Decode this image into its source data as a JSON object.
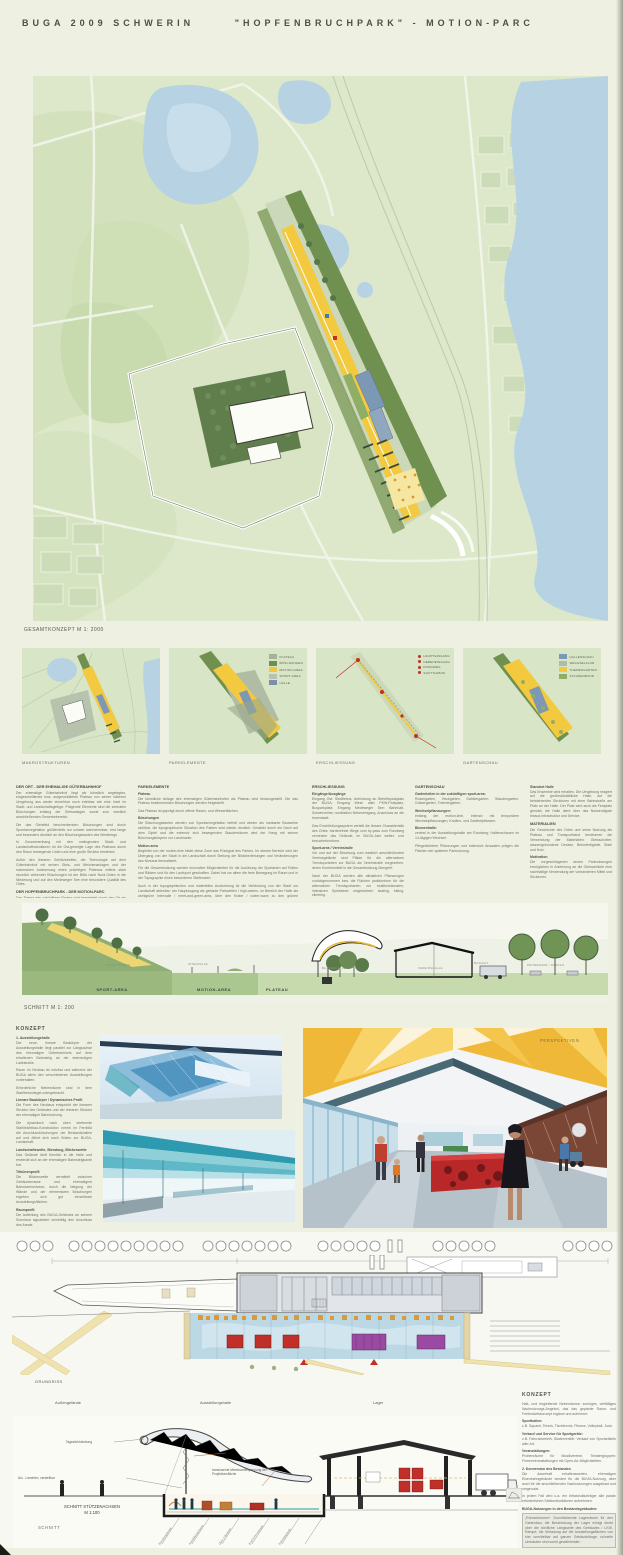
{
  "page": {
    "title_left": "BUGA 2009 SCHWERIN",
    "title_right": "\"HOPFENBRUCHPARK\" - MOTION-PARC"
  },
  "colors": {
    "map_green": "#dce8c9",
    "water": "#b7d3e3",
    "boeschung_olive": "#70904f",
    "motion_yellow": "#f2c93f",
    "plateau": "#cbd8ba",
    "halle_blue": "#7d98b5",
    "canopy_orange": "#f0b838",
    "exhibit_red": "#c03028",
    "exhibit_purple": "#9a4aa0"
  },
  "masterplan": {
    "caption": "GESAMTKONZEPT  M 1: 2000"
  },
  "panels": {
    "p1": {
      "caption": "MAKROSTRUKTUREN"
    },
    "p2": {
      "caption": "PARKELEMENTE",
      "legend": [
        {
          "label": "PLATEAU",
          "color": "#a4b296"
        },
        {
          "label": "BÖSCHUNGEN",
          "color": "#6e8f4f"
        },
        {
          "label": "MOTION-AREA",
          "color": "#f0c840"
        },
        {
          "label": "SPORT-AREA",
          "color": "#b9c2b2"
        },
        {
          "label": "HALLE",
          "color": "#7b8fa6"
        }
      ]
    },
    "p3": {
      "caption": "ERSCHLIESSUNG",
      "legend": [
        {
          "label": "HAUPTEINGANG"
        },
        {
          "label": "NEBENEINGANG"
        },
        {
          "label": "RUNDWEG"
        },
        {
          "label": "SHUTTLEBUS"
        }
      ]
    },
    "p4": {
      "caption": "GARTENSCHAU",
      "legend": [
        {
          "label": "HALLENSCHAU"
        },
        {
          "label": "WECHSELFLOR"
        },
        {
          "label": "THEMENGÄRTEN"
        },
        {
          "label": "STAUDENBAND"
        }
      ]
    }
  },
  "columns": [
    {
      "blocks": [
        {
          "type": "h",
          "text": "DER ORT - DER EHEMALIGE GÜTERBAHNHOF"
        },
        {
          "type": "p",
          "text": "Der ehemalige Güterbahnhof liegt als künstlich angelegtes, eingeschnittenes bzw. aufgeschüttetes Plateau von seiner näheren Umgebung aus weder einsehbar noch erlebbar wie eine Insel im Stadt- und Landschaftsgefüge. Prägende Elemente sind die zentralen Böschungen entlang der Gleisanlagen sowie zum westlich anschließenden Gewerbebereich."
        },
        {
          "type": "p",
          "text": "Die das Gleisfeld beschreibenden Böschungen sind durch Spontanvegetation größtenteils nur schwer wahrnehmbar, erst lange und besonders deutlich an den Böschungskanten des Westbergs."
        },
        {
          "type": "p",
          "text": "In Zusammenhang mit den umliegenden Stadt- und Landschaftsstrukturen ist die Ost-geneigte Lage des Plateaus durch den Raum bewegende Linien und eine große Struktur bestimmt."
        },
        {
          "type": "p",
          "text": "Außer den linearen Gehölzstreifen, der Technologie auf dem Güterbahnhof mit seinen Gleis- und Weichenanlagen und der naturnahen Ausformung eines prächtigen Plateaus mittels stark räumlich wirkender Böschungen ist der Blick nach Nord-Osten in die Niederung und auf den Medeweger See eine besondere Qualität des Ortes."
        },
        {
          "type": "h",
          "text": "DER HOPFENBRUCHPARK - DER MOTION-PARC"
        },
        {
          "type": "p",
          "text": "Das Thema des zukünftigen Parkes wird hergeleitet durch den Ort als ehemaliger Güterbahnhof und seine vorhandenen Strukturen: Lineare Elemente, Bewegung, ständige Veränderung, Motion."
        },
        {
          "type": "p",
          "text": "Der Park hat einen offenen großzügigen Charakter und stellt die Verbindung zwischen der Stadt und der Landschaft mit dem Medeweger See im Norden her."
        },
        {
          "type": "p",
          "text": "Er wird deutlich in die Zonen gegliedert: Plateau, Böschungen, motion-area und sport-area."
        }
      ]
    },
    {
      "blocks": [
        {
          "type": "h",
          "text": "PARKELEMENTE"
        },
        {
          "type": "h2",
          "text": "Plateau"
        },
        {
          "type": "p",
          "text": "Die künstliche Anlage des ehemaligen Güterbahnhofes als Plateau wird herausgestellt. Die das Plateau bestimmenden Böschungen werden freigestellt."
        },
        {
          "type": "p",
          "text": "Das Plateau ist geprägt durch offene Rasen- und Wiesenflächen."
        },
        {
          "type": "h2",
          "text": "Böschungen"
        },
        {
          "type": "p",
          "text": "Die Böschungskanten werden von Spontanvegetation befreit und wieder als markante Bauwerke sichtbar, die topographische Situation des Parkes wird wieder deutlich. Gestärkt durch ein Dach auf dem Gipfel und die extensiv sich bewegenden Staudenräume wird der Hang mit seinen Böschungskörpern zur Landmarke."
        },
        {
          "type": "h2",
          "text": "Motion-area"
        },
        {
          "type": "p",
          "text": "Begleitet von der motion-linie bildet diese Zone das Rückgrat des Parkes. Im oberen Bereich wird der Übergang von der Stadt in die Landschaft durch Stellung der Blickbeziehungen und Veränderungen des Niveaus thematisiert."
        },
        {
          "type": "p",
          "text": "Für die Gesamtnutzung werden innovative Möglichkeiten für die Ausübung der Sportarten auf Rollen und Rädern und für den Laufsport geschaffen. Dabei hat vor allem die freie Bewegung im Raum und in der Topographie einen besonderen Stellenwert."
        },
        {
          "type": "p",
          "text": "Auch in der topographischen und materiellen Ausformung ist die Verbindung von der Stadt zur Landschaft ablesbar: am Hauptzugang als gebaute Parkwellen / high-waves, im Bereich der Halle als wohlgrüne Intervalle / meet-and-green-area, über den Krater / crater-wave zu den grünen Landschaftswellen / green-range oberhalb des Medeweger Sees."
        }
      ]
    },
    {
      "blocks": [
        {
          "type": "h",
          "text": "ERSCHLIESSUNG"
        },
        {
          "type": "h2",
          "text": "Eingänge/Ausgänge"
        },
        {
          "type": "p",
          "text": "Eingang Ost: Shuttlebus, Anbindung an Behelfsparkplatz der BUGA; Eingang West: alter PKW-Parkplatz, Busparkplatz; Eingang Medeweger See: Bahnhalt, Schwimmline; nordöstlich Nebeneingang, Anschluss an die Innenstadt."
        },
        {
          "type": "p",
          "text": "Das Erschließungssystem verteilt die lineare Charakteristik des Ortes: barrierefreie Wege vom by-pass zum Rundweg vernetzen das Gelände, im BUGA-Jahr wetter- und besucherkonform."
        },
        {
          "type": "h2",
          "text": "Sport-area / Vereinshalle"
        },
        {
          "type": "p",
          "text": "Vor und auf der Böschung zum westlich anschließenden Vereinsgelände sind Plätze für die alternativen Trendsportarten zur BUGA als Vereinshalle vorgesehen, deren Kombiumfeld in die Gesamtnutzung übergeht."
        },
        {
          "type": "p",
          "text": "Nach der BUGA werden alle attraktiven Pflanzungen zurückgenommen bzw. die Flächen parkkonform für die alternativen Trendsportarten zur multifunktionalen, intensiven Spielwiese umgewidmet: skating, biking, climbing."
        }
      ]
    },
    {
      "blocks": [
        {
          "type": "h",
          "text": "GARTENSCHAU"
        },
        {
          "type": "h2",
          "text": "Gartenteilen in der zukünftigen sport-area:"
        },
        {
          "type": "p",
          "text": "Rosengarten, Heckgarten, Dahliengarten, Staudengarten, Gräsergarten, Themengärten."
        },
        {
          "type": "h2",
          "text": "Wechselpflanzungen:"
        },
        {
          "type": "p",
          "text": "entlang der motion-linie, intensiv mit temporären Wechselpflanzungen, Knollen- und Zwiebelpflanzen."
        },
        {
          "type": "h2",
          "text": "Blumenhalle:"
        },
        {
          "type": "p",
          "text": "zentral in der Ausstellungshalle am Rundweg; Hallenschauen im 14-tägigen Wechsel."
        },
        {
          "type": "p",
          "text": "Pflegeleichtere Pflanzungen und extensive Ansaaten prägen die Flächen der späteren Parknutzung."
        }
      ]
    },
    {
      "blocks": [
        {
          "type": "h2",
          "text": "Standort Halle"
        },
        {
          "type": "p",
          "text": "Das Ensemble wird erhalten. Die Umgebung reagiert auf die großmaßstäbliche Halle, auf die freistehenden Strukturen mit einer Bahnstraße am Platz an der Halle. Der Platz wird auch als Festplatz genutzt; die Halle dient über das Notwendigste hinaus Infrastruktur und Service."
        },
        {
          "type": "h",
          "text": "MATERIALIEN"
        },
        {
          "type": "p",
          "text": "Die Geschichte des Ortes und seine Nutzung als Plateau und Transportband bestimmen die Verwendung der Materialien: Gleisschotter, wassergebundene Decken, Betonfertigteile, Stahl und Holz."
        },
        {
          "type": "h2",
          "text": "Motivation"
        },
        {
          "type": "p",
          "text": "Die vorgeschlagenen neuen Parknutzungen ermöglichen in Anlehnung an die Gleisverläufe eine nachhaltige Verwendung der vorhandenen Mittel und Strukturen."
        }
      ]
    }
  ],
  "section200": {
    "caption": "SCHNITT M 1: 200",
    "zones": [
      "SPORT-AREA",
      "MOTION-AREA",
      "PLATEAU"
    ],
    "small_labels": [
      "SPORTFELDER",
      "INTERVALLE",
      "BLUMENHALLE",
      "VEREINSHALLE",
      "BUSHALT",
      "PROMENADE / PARKEN"
    ]
  },
  "konzept": {
    "title": "KONZEPT",
    "perspective_label": "PERSPEKTIVEN",
    "blocks": [
      {
        "type": "h2",
        "text": "1. Ausstellungshalle"
      },
      {
        "type": "p",
        "text": "Der neue, lineare Baukörper der Ausstellungshalle liegt parallel zur Längsachse des ehemaligen Güterbahnhofs auf dem erhaltenen Bahnsteig an der ebenerdigen Ladestraße."
      },
      {
        "type": "p",
        "text": "Raum im Neubau ist nutzbar und während der BUGA allein den verschiedenen Ausstellungen vorbehalten."
      },
      {
        "type": "p",
        "text": "Erforderliche Nebenräume sind in dem Stahlbetonriegel untergebracht."
      },
      {
        "type": "h2",
        "text": "Lineare Baukörper / Dynamisches Profil"
      },
      {
        "type": "p",
        "text": "Die Form des Neubaus entspricht der linearen Struktur des Geländes und der linearen Struktur der ehemaligen Bahnnutzung."
      },
      {
        "type": "p",
        "text": "Die dynamisch nach oben strebende Stahlleichtbau-Konstruktion nimmt im Fernbild die Anschlussböschungen der Bestandshallen auf und öffnet sich nach Süden zur BUGA-Landschaft."
      },
      {
        "type": "h2",
        "text": "Landschaftsweite, Biendung, Blickenweite"
      },
      {
        "type": "p",
        "text": "Das Gelände läuft förmlich in die Halle und erstreckt sich an der ehemaligen Bahnsteigkante fort."
      },
      {
        "type": "h2",
        "text": "Tribünenprofil"
      },
      {
        "type": "p",
        "text": "Die Blickenweite vermittelt zwischen Gebäudemasse und ehemaligem Bahndammniveau; durch die Neigung der Wände und der elementaren Böschungen ergeben sich gut einsehbare Ausstellungsflächen."
      },
      {
        "type": "h2",
        "text": "Raumprofil"
      },
      {
        "type": "p",
        "text": "Die Aufteilung des BUGA-Geländes an seinem Sonnland signalisiert sinnbildig den Anschluss des Areals."
      },
      {
        "type": "h2",
        "text": "Eingänge"
      },
      {
        "type": "p",
        "text": "Die derzeitig angeschlossenen Shuttlebusse ergeben eine selbsterklärende Besucherführung durch die Halle; unter der Gebäudehülle hindurch sind Innenraum und Außengelände verknüpfbar."
      },
      {
        "type": "h2",
        "text": "Bauelement Rooftop / Modul - Recycling"
      },
      {
        "type": "p",
        "text": "Für Nachnutzungen kann die Ausstellungshalle schrittweise in Modullängen von 12,50 m rückgebaut werden; rückgebaute Konstruktionen und Gewebemembranen sind wiederverwendbar."
      }
    ]
  },
  "grundriss": {
    "caption": "GRUNDRISS",
    "labels": [
      "Außengelände",
      "Ausstellungshalle",
      "Lager"
    ]
  },
  "section100": {
    "ann_roof": "Tageslichtdeckung",
    "ann_lamellen": "Alu - Lamellen, verstellbar",
    "ann_membran": "transluzente Membranbespannung der Projektionsfläche",
    "caption1": "SCHNITT STÜTZENACHSEN",
    "caption2": "M 1:100",
    "caption3": "SCHNITT",
    "axis_labels": [
      "Böschungskante",
      "Ausstellungsebene",
      "Gleis 1 Bestand",
      "BUGA-Promenade",
      "Bahnsteigkante"
    ]
  },
  "konzept2": {
    "title": "KONZEPT",
    "blocks": [
      {
        "type": "p",
        "text": "Halt- und begleitende Nebenräume; sonniges, vielfältiges Nachnutzungs-Angebot, das das geplante Raum- und Freibedarfskonzept ergänzt und aufnimmt:"
      },
      {
        "type": "h2",
        "text": "Sporthallen:"
      },
      {
        "type": "p",
        "text": "z.B. Squash, Tennis, Tischtennis, Fitness, Volleyball, Judo."
      },
      {
        "type": "h2",
        "text": "Verkauf und Service für Sportgeräte:"
      },
      {
        "type": "p",
        "text": "z.B. Fahrradverleih, Skaterverleih; Verkauf von Sportartikeln aller Art."
      },
      {
        "type": "h2",
        "text": "Veranstaltungen:"
      },
      {
        "type": "p",
        "text": "Probenräume für Musikvereine, Theatergruppen; Firmenveranstaltungen mit Open-Air-Möglichkeiten."
      },
      {
        "type": "h2",
        "text": "2. Konversion des Bestandes"
      },
      {
        "type": "p",
        "text": "Die dauerhaft erhaltenswerten, ehemaligen Eisenbahngebäude werden für die BUGA-Nutzung, aber auch für die anschließenden Nachnutzungen ausgebaut und umgenutzt."
      },
      {
        "type": "p",
        "text": "In jedem Fall wird u.a. ein Infrastrukturträger alle passiv erforderlichen Stationsfunktionen aufnehmen."
      },
      {
        "type": "h2",
        "text": "BUGA-Nutzungen in den Bestandsgebäuden:"
      },
      {
        "type": "box",
        "text": "„Rohrscheunen“: Durchfahrende Lagerräume für den Gartenbau; die Beschickung der Lager erfolgt direkt über die nördliche Längsseite des Gebäudes / LKW-Rampe; die Verladung auf die Ausstellungsflächen von hier unmittelbar auf ganzer Gebäudelänge; schnelle Umbauten sind somit gewährleistet."
      },
      {
        "type": "box",
        "text": "„Messezwischenlager / Showroom für die Verbände“: alle wöchentlichen Neueinrichtungen in den Hallen der Bestandsbauten untergebracht; Zwischenlager, LKW-Verladung zur Halle sowie interne Hallennutzungen sind gesichert."
      },
      {
        "type": "box",
        "text": "Café: eine Besucherzone mit direkt zur „Weingarten“-Terrasse an der nordöstlichen Außenanlage, direkt am Rundweg und zentral zur Ausstellungshalle, mit Blick über das Gelände und zum BUGA-Gelände; der Sonderort am See."
      }
    ]
  }
}
